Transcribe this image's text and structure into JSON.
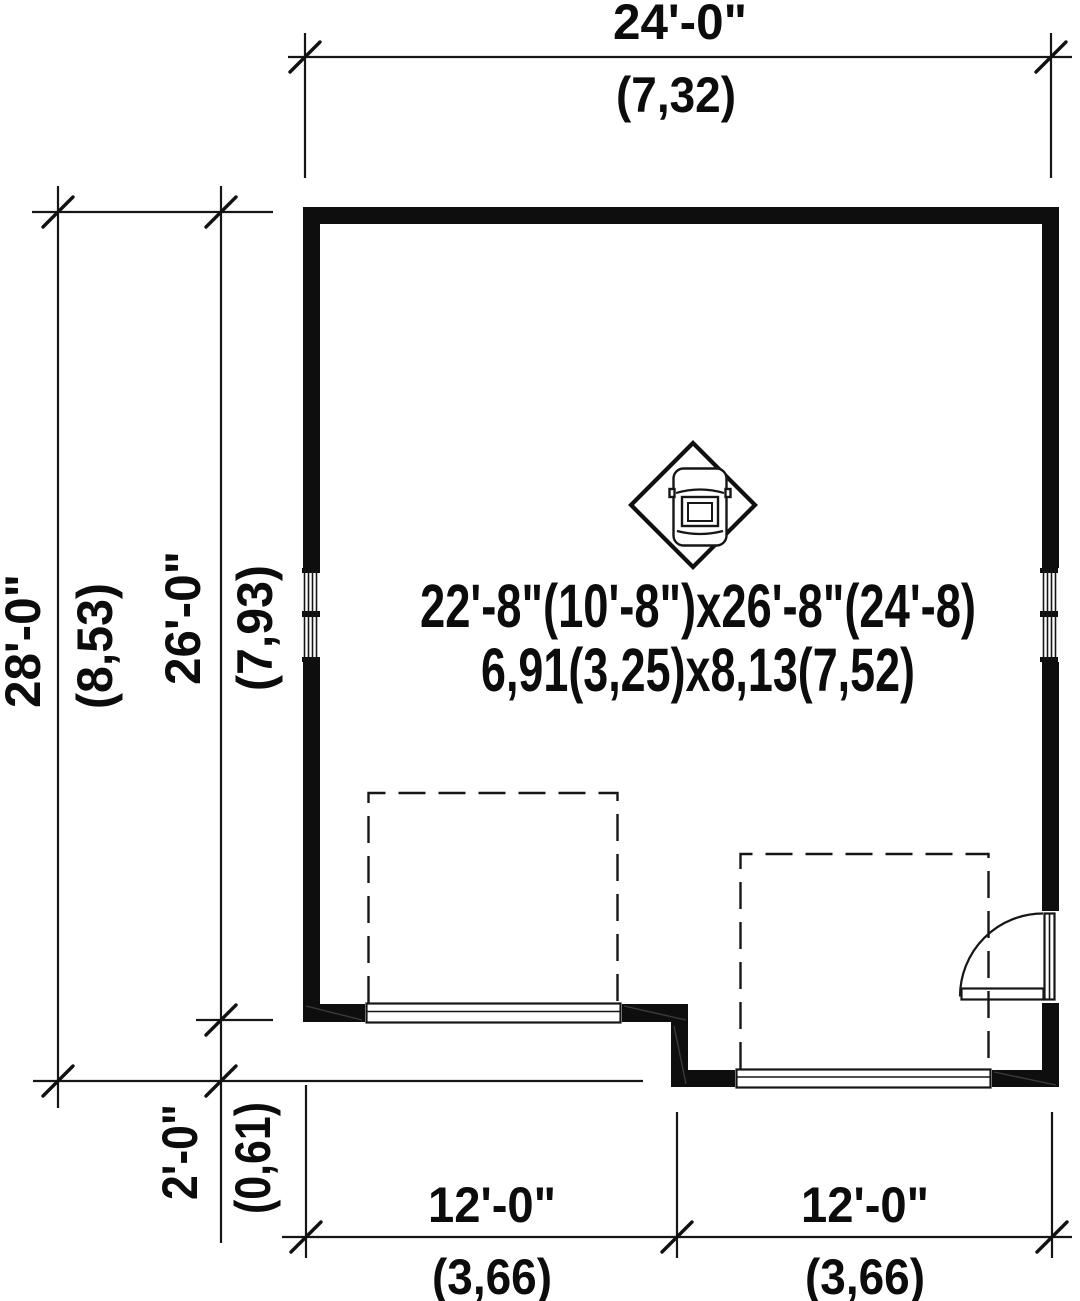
{
  "plan": {
    "type": "garage-floor-plan",
    "colors": {
      "ink": "#111111",
      "paper": "#ffffff"
    },
    "room_label": {
      "imperial": "22'-8\"(10'-8\")x26'-8\"(24'-8)",
      "metric": "6,91(3,25)x8,13(7,52)"
    },
    "dimensions": {
      "top_width": {
        "imperial": "24'-0\"",
        "metric": "(7,32)"
      },
      "left_overall_depth": {
        "imperial": "28'-0\"",
        "metric": "(8,53)"
      },
      "left_main_depth": {
        "imperial": "26'-0\"",
        "metric": "(7,93)"
      },
      "left_offset_depth": {
        "imperial": "2'-0\"",
        "metric": "(0,61)"
      },
      "bottom_left_bay": {
        "imperial": "12'-0\"",
        "metric": "(3,66)"
      },
      "bottom_right_bay": {
        "imperial": "12'-0\"",
        "metric": "(3,66)"
      }
    }
  }
}
